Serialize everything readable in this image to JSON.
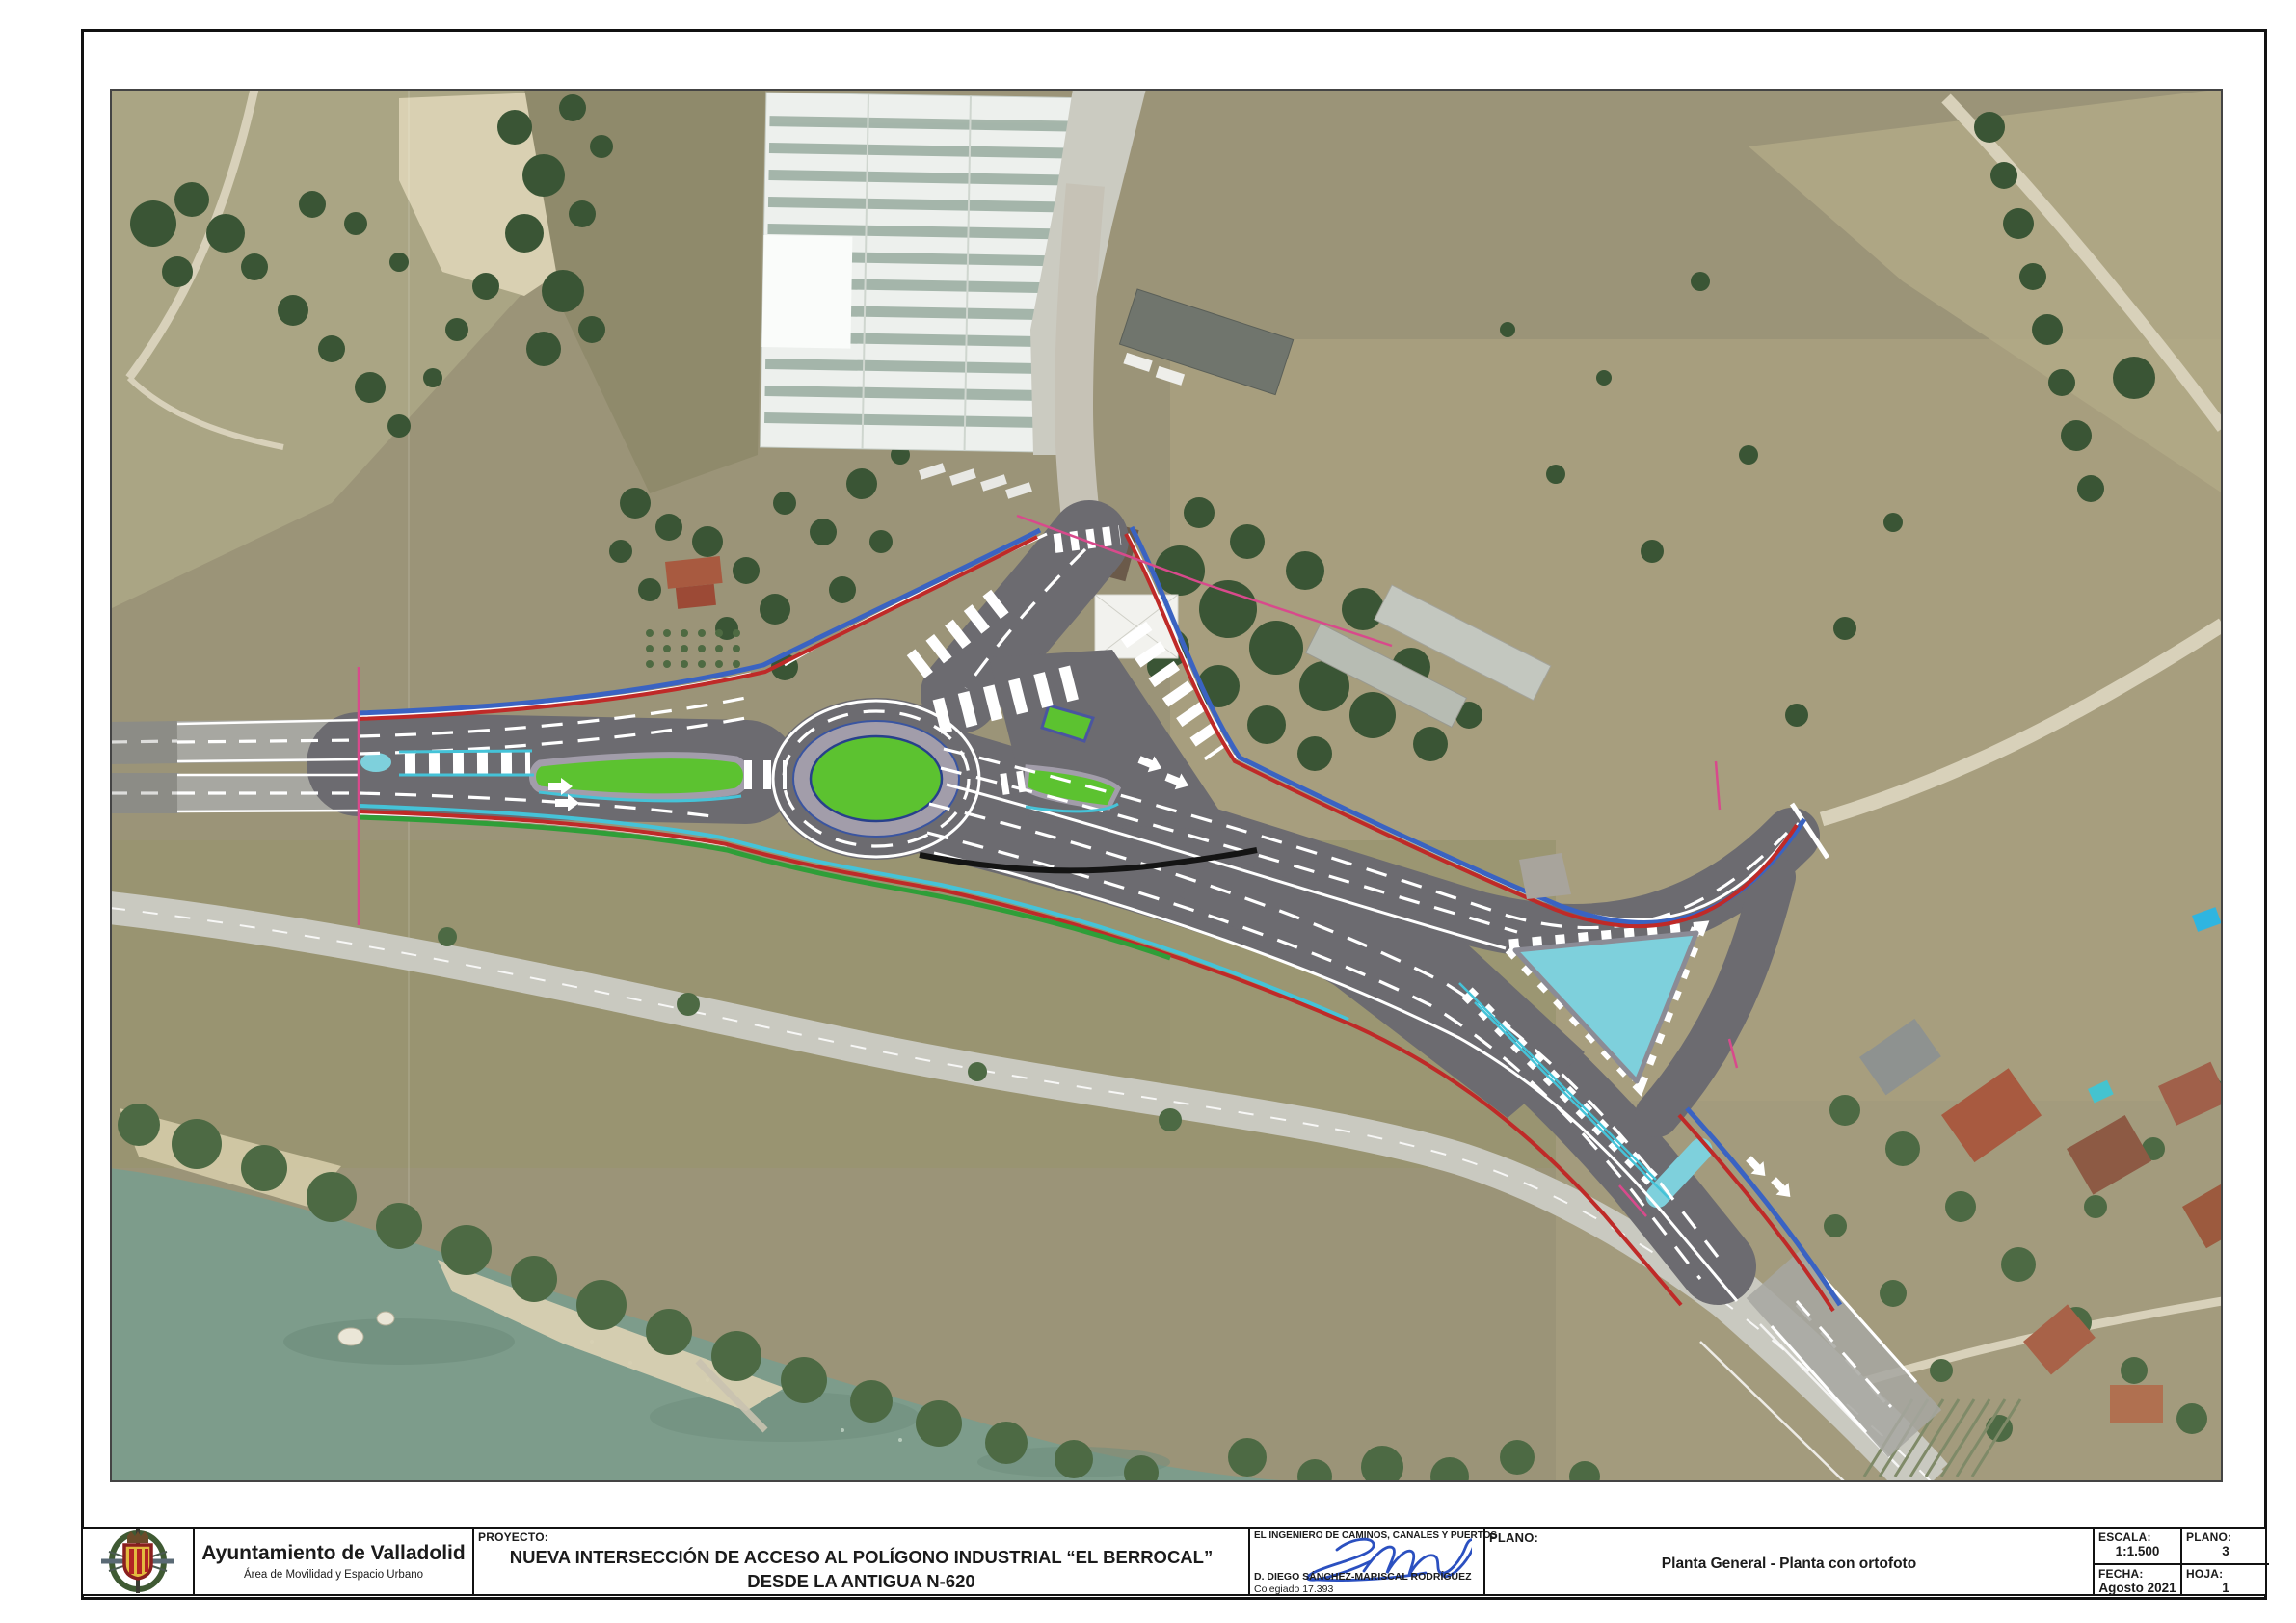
{
  "document": {
    "kind": "engineering plan sheet over orthophoto",
    "sheet_background": "#ffffff"
  },
  "map": {
    "description": "Planta general de nueva intersección (glorieta) sobre ortofoto aérea",
    "colors": {
      "field_olive": "#9b9478",
      "field_light": "#aaa584",
      "field_dark": "#8f8a6b",
      "field_right": "#a89f7e",
      "sand": "#d9d0b2",
      "dirt_road": "#d8d1ba",
      "old_road": "#c9c9c0",
      "water": "#7d9c8b",
      "trees_dark": "#3a5535",
      "trees_mid": "#4d6a44",
      "asphalt": "#6c6b70",
      "resurfaced": "#a7a7a1",
      "photo_road": "#8c8c86",
      "apron": "#a29daa",
      "island_green": "#5cc230",
      "island_cyan": "#7ed0dc",
      "line_cyan": "#45c3d8",
      "line_blue": "#3a63c2",
      "line_red": "#bf2a28",
      "line_green": "#2f9e38",
      "boundary_magenta": "#d84a8c",
      "warehouse_roof": "#edf0ed",
      "warehouse_stripe": "#93a79a",
      "roof_red": "#a85a40",
      "marking_white": "#ffffff"
    }
  },
  "title_block": {
    "organization": {
      "name": "Ayuntamiento de Valladolid",
      "department": "Área de Movilidad y Espacio Urbano"
    },
    "project": {
      "label": "PROYECTO:",
      "title_line1": "NUEVA INTERSECCIÓN DE ACCESO AL POLÍGONO INDUSTRIAL “EL BERROCAL”",
      "title_line2": "DESDE LA ANTIGUA N-620"
    },
    "engineer": {
      "heading": "EL INGENIERO DE CAMINOS, CANALES Y PUERTOS",
      "name": "D. DIEGO SÁNCHEZ-MARISCAL RODRÍGUEZ",
      "license": "Colegiado 17.393"
    },
    "plano": {
      "label": "PLANO:",
      "title": "Planta General - Planta con ortofoto"
    },
    "escala": {
      "label": "ESCALA:",
      "value": "1:1.500"
    },
    "plano_num": {
      "label": "PLANO:",
      "value": "3"
    },
    "fecha": {
      "label": "FECHA:",
      "value": "Agosto 2021"
    },
    "hoja": {
      "label": "HOJA:",
      "value": "1"
    }
  }
}
